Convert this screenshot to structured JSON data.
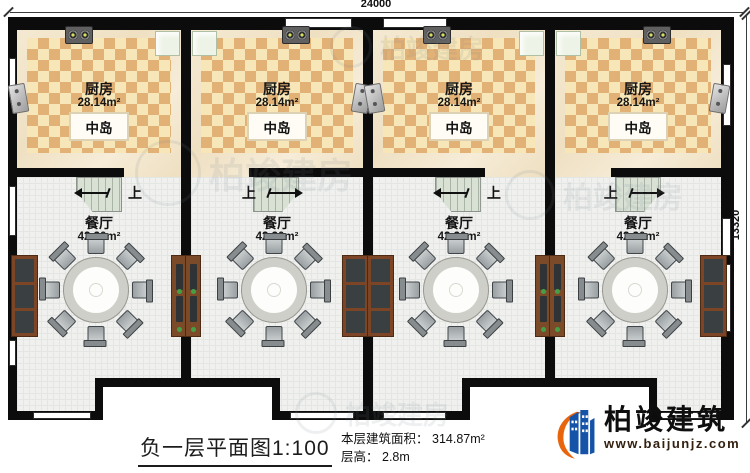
{
  "plan": {
    "dimensions": {
      "top_width": "24000",
      "right_height": "13320"
    },
    "units": [
      {
        "kitchen": {
          "label": "厨房",
          "area": "28.14m²",
          "island_label": "中岛"
        },
        "dining": {
          "label": "餐厅",
          "area": "42.30m²"
        },
        "stair_label": "上"
      },
      {
        "kitchen": {
          "label": "厨房",
          "area": "28.14m²",
          "island_label": "中岛"
        },
        "dining": {
          "label": "餐厅",
          "area": "42.30m²"
        },
        "stair_label": "上"
      },
      {
        "kitchen": {
          "label": "厨房",
          "area": "28.14m²",
          "island_label": "中岛"
        },
        "dining": {
          "label": "餐厅",
          "area": "42.30m²"
        },
        "stair_label": "上"
      },
      {
        "kitchen": {
          "label": "厨房",
          "area": "28.14m²",
          "island_label": "中岛"
        },
        "dining": {
          "label": "餐厅",
          "area": "42.30m²"
        },
        "stair_label": "上"
      }
    ]
  },
  "footer": {
    "title": {
      "text": "负一层平面图",
      "scale": "1:100"
    },
    "info": {
      "area_label": "本层建筑面积：",
      "area_value": "314.87m²",
      "floor_height_label": "层高：",
      "floor_height_value": "2.8m"
    }
  },
  "brand": {
    "name": "柏竣建筑",
    "website": "www.baijunjz.com",
    "accent_orange": "#e8650d",
    "accent_blue": "#1553a8"
  },
  "watermark": {
    "text": "柏竣建房"
  }
}
